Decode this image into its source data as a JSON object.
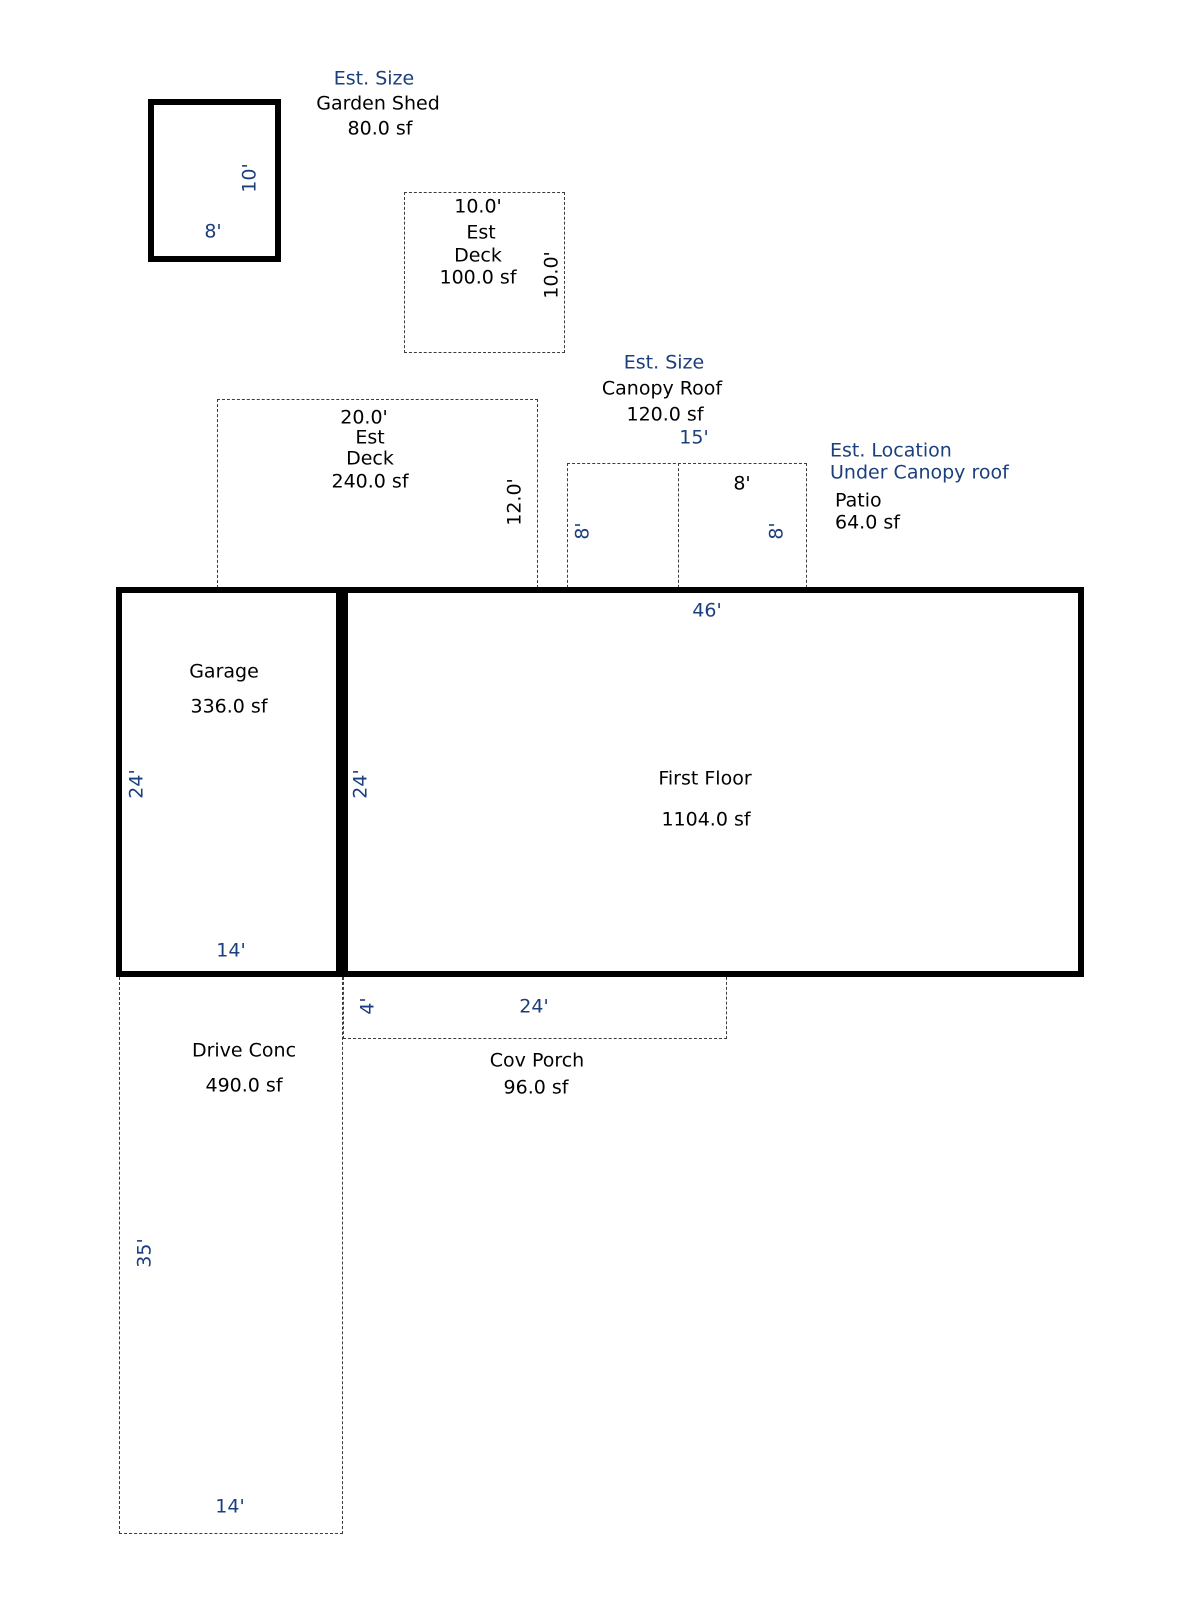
{
  "colors": {
    "dimension_text": "#1b3e7d",
    "label_text": "#000000",
    "wall_line": "#000000",
    "estimate_line": "#3c3c3c"
  },
  "shapes": {
    "garden_shed": {
      "note": "Est. Size",
      "name": "Garden Shed",
      "area": "80.0 sf",
      "side_dim": "10'",
      "bottom_dim": "8'"
    },
    "small_deck": {
      "top_dim": "10.0'",
      "label_line1": "Est",
      "label_line2": "Deck",
      "area": "100.0 sf",
      "side_dim": "10.0'"
    },
    "large_deck": {
      "top_dim": "20.0'",
      "label_line1": "Est",
      "label_line2": "Deck",
      "area": "240.0 sf",
      "side_dim": "12.0'"
    },
    "canopy_roof": {
      "note": "Est. Size",
      "name": "Canopy Roof",
      "area": "120.0 sf",
      "top_dim": "15'",
      "left_side_dim": "8'",
      "right_side_dim": "8'",
      "patio_top_dim": "8'"
    },
    "patio": {
      "note_line1": "Est. Location",
      "note_line2": "Under Canopy roof",
      "name": "Patio",
      "area": "64.0 sf"
    },
    "garage": {
      "name": "Garage",
      "area": "336.0 sf",
      "side_dim": "24'",
      "bottom_dim": "14'"
    },
    "first_floor": {
      "name": "First Floor",
      "area": "1104.0 sf",
      "top_dim": "46'",
      "side_dim": "24'"
    },
    "cov_porch": {
      "name": "Cov Porch",
      "area": "96.0 sf",
      "side_dim": "4'",
      "top_dim": "24'"
    },
    "driveway": {
      "name": "Drive Conc",
      "area": "490.0 sf",
      "side_dim": "35'",
      "bottom_dim": "14'"
    }
  }
}
